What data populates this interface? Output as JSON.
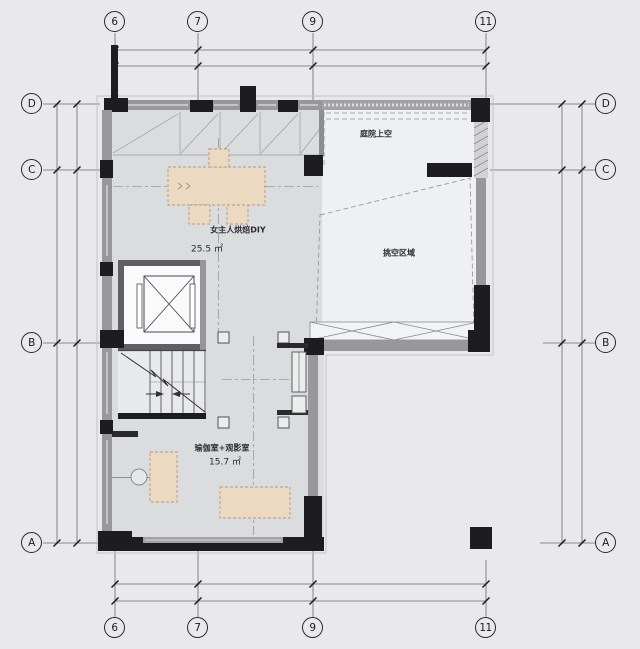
{
  "drawing": {
    "type": "residential floor plan",
    "background": "#e9e9eb"
  },
  "grid": {
    "top": [
      "6",
      "7",
      "9",
      "11"
    ],
    "bottom": [
      "6",
      "7",
      "9",
      "11"
    ],
    "left": [
      "D",
      "C",
      "B",
      "A"
    ],
    "right": [
      "D",
      "C",
      "B",
      "A"
    ]
  },
  "rooms": {
    "baking": {
      "label": "女主人烘焙DIY",
      "area": "25.5 ㎡"
    },
    "terrace": {
      "label": "庭院上空"
    },
    "void": {
      "label": "挑空区域"
    },
    "yoga": {
      "label": "瑜伽室+观影室",
      "area": "15.7 ㎡"
    }
  },
  "colors": {
    "wall_black": "#1d1d1f",
    "wall_gray": "#98989c",
    "floor_gray": "#dbdcde",
    "floor_open": "#eff0f2",
    "furniture": "#ecd9c1",
    "furniture_border": "#b5967a",
    "dim_line": "#6a6a6e"
  }
}
